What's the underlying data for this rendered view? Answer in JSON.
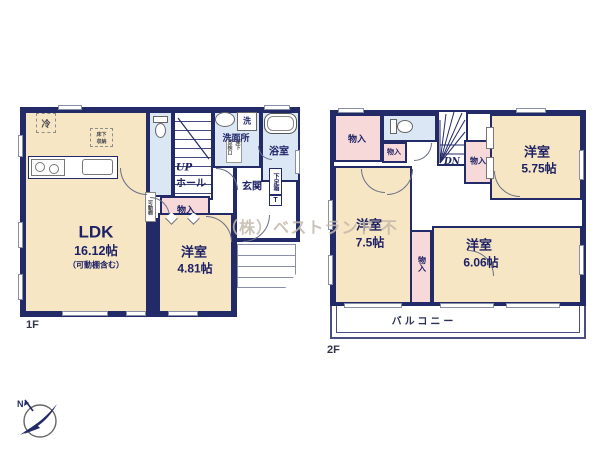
{
  "colors": {
    "wall": "#232a68",
    "room_cream": "#f6e6c4",
    "storage_pink": "#f8d9da",
    "wet_blue": "#dbe7f4",
    "watermark": "#c3b9ab"
  },
  "watermark": "（株）ベストランド 不",
  "compass_n": "N",
  "f1": {
    "floor_label": "1F",
    "fridge": "冷",
    "ufs1": "床下",
    "ufs2": "収納",
    "washer": "洗",
    "washroom": "洗面所",
    "hatch_left": "点検口",
    "hatch_right": "床下",
    "bathroom": "浴室",
    "entrance": "玄関",
    "shoebox": "下足箱",
    "shoebox_t": "T",
    "up": "UP",
    "hall": "ホール",
    "storage": "物入",
    "movable_shelf": "可動棚",
    "ldk": {
      "name": "LDK",
      "size": "16.12帖",
      "note": "（可動棚含む）"
    },
    "room": {
      "name": "洋室",
      "size": "4.81帖"
    }
  },
  "f2": {
    "floor_label": "2F",
    "dn": "DN",
    "storage_tl": "物入",
    "storage_small": "物入",
    "storage_right": "物入",
    "storage_mid": "物入",
    "room1": {
      "name": "洋室",
      "size": "5.75帖"
    },
    "room2": {
      "name": "洋室",
      "size": "7.5帖"
    },
    "room3": {
      "name": "洋室",
      "size": "6.06帖"
    },
    "balcony": "バルコニー"
  }
}
